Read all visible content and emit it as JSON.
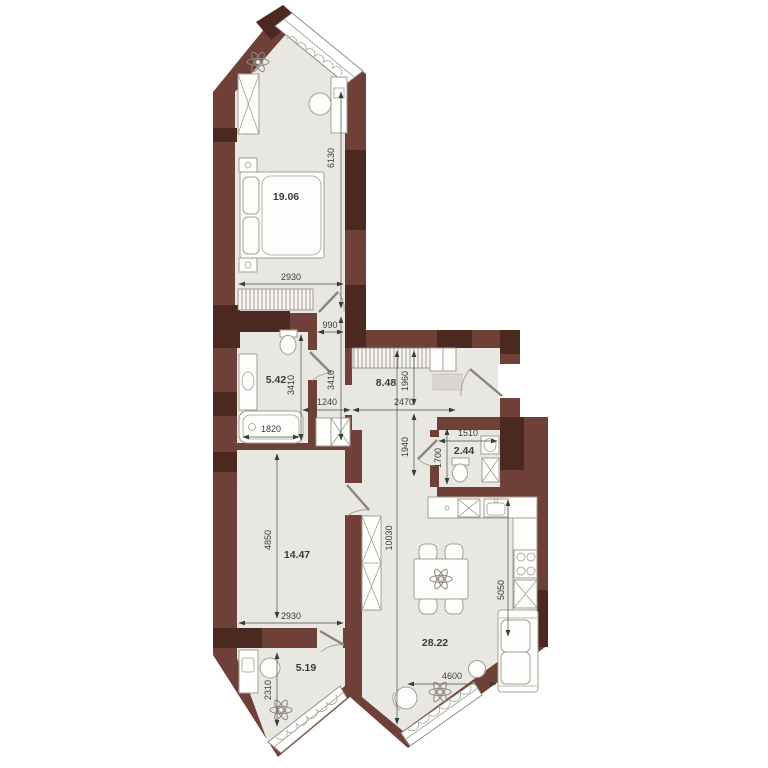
{
  "plan": {
    "type": "apartment-floor-plan",
    "rooms": [
      {
        "name": "bedroom-1",
        "area": "19.06"
      },
      {
        "name": "bathroom",
        "area": "5.42"
      },
      {
        "name": "hallway",
        "area": "8.48"
      },
      {
        "name": "wc",
        "area": "2.44"
      },
      {
        "name": "bedroom-2",
        "area": "14.47"
      },
      {
        "name": "kitchen-living-room",
        "area": "28.22"
      },
      {
        "name": "cabinet",
        "area": "5.19"
      }
    ],
    "dims": {
      "d6130": "6130",
      "d2930_bed1": "2930",
      "d990": "990",
      "d3410_bath": "3410",
      "d3410_corr": "3410",
      "d1240": "1240",
      "d1820": "1820",
      "d2470": "2470",
      "d1960": "1960",
      "d1940": "1940",
      "d1510": "1510",
      "d1700": "1700",
      "d4850": "4850",
      "d2930_bed2": "2930",
      "d10030": "10030",
      "d5050": "5050",
      "d4600": "4600",
      "d2310": "2310"
    },
    "colors": {
      "wall": "#6f4037",
      "wall_dark": "#4b2820",
      "floor": "#e9e7e2",
      "outline": "#a39e95"
    }
  }
}
